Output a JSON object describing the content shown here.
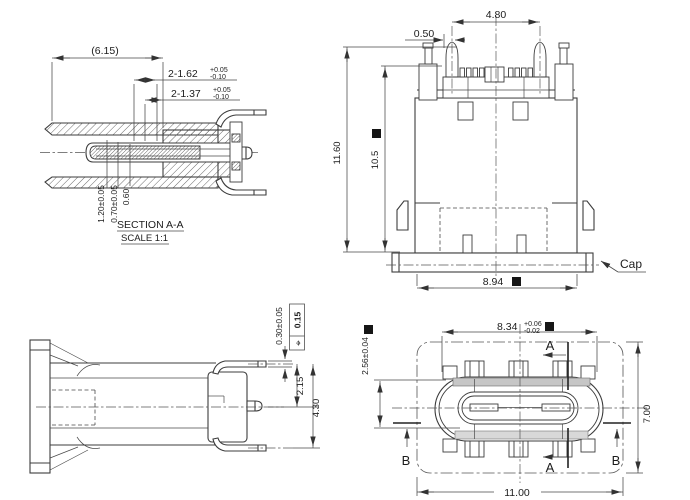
{
  "drawing": {
    "section_view": {
      "title": "SECTION A-A",
      "scale_note": "SCALE 1:1",
      "dim_overall_length": "(6.15)",
      "dim_slot_a_main": "2-1.62",
      "dim_slot_a_tol_plus": "+0.05",
      "dim_slot_a_tol_minus": "-0.10",
      "dim_slot_b_main": "2-1.37",
      "dim_slot_b_tol_plus": "+0.05",
      "dim_slot_b_tol_minus": "-0.10",
      "dim_tongue_total": "1.20±0.05",
      "dim_tongue_mid": "0.70±0.05",
      "dim_tongue_tip": "0.60"
    },
    "front_view": {
      "dim_peg_span": "4.80",
      "dim_peg_offset": "0.50",
      "dim_total_height": "11.60",
      "dim_body_height": "10.5",
      "dim_base_width": "8.94",
      "cap_label": "Cap"
    },
    "side_view": {
      "dim_lead_height": "0.30±0.05",
      "fcf_symbol": "⌖",
      "fcf_tolerance": "0.15",
      "dim_pin_to_lead": "2.15",
      "dim_lead_to_lead": "4.30"
    },
    "plan_view": {
      "dim_shell_width_main": "8.34",
      "dim_shell_width_tol_plus": "+0.06",
      "dim_shell_width_tol_minus": "-0.02",
      "dim_shell_height": "2.56±0.04",
      "dim_body_depth": "7.00",
      "dim_overall_width": "11.00",
      "section_label_a": "A",
      "section_label_b": "B"
    }
  }
}
